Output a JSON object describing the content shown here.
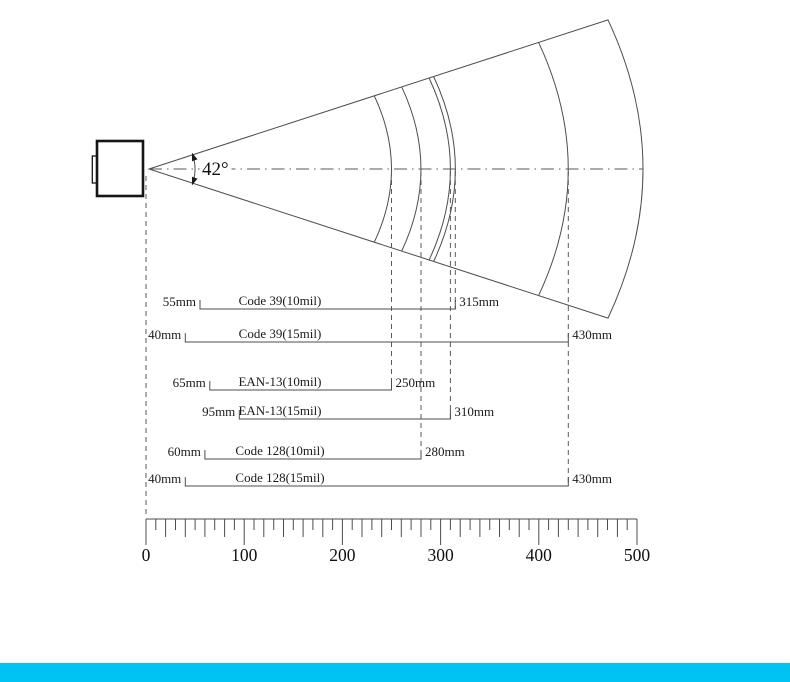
{
  "angle_label": "42°",
  "beam": {
    "angle_deg": 42,
    "arc_distances_mm": [
      250,
      280,
      310,
      315,
      430
    ]
  },
  "ranges": [
    {
      "name": "Code 39(10mil)",
      "near": "55mm",
      "far": "315mm",
      "near_mm": 55,
      "far_mm": 315
    },
    {
      "name": "Code 39(15mil)",
      "near": "40mm",
      "far": "430mm",
      "near_mm": 40,
      "far_mm": 430
    },
    {
      "name": "EAN-13(10mil)",
      "near": "65mm",
      "far": "250mm",
      "near_mm": 65,
      "far_mm": 250
    },
    {
      "name": "EAN-13(15mil)",
      "near": "95mm",
      "far": "310mm",
      "near_mm": 95,
      "far_mm": 310
    },
    {
      "name": "Code 128(10mil)",
      "near": "60mm",
      "far": "280mm",
      "near_mm": 60,
      "far_mm": 280
    },
    {
      "name": "Code 128(15mil)",
      "near": "40mm",
      "far": "430mm",
      "near_mm": 40,
      "far_mm": 430
    }
  ],
  "ruler": {
    "unit_labels": [
      "0",
      "100",
      "200",
      "300",
      "400",
      "500"
    ]
  },
  "colors": {
    "footer_bar": "#00c3f4"
  }
}
